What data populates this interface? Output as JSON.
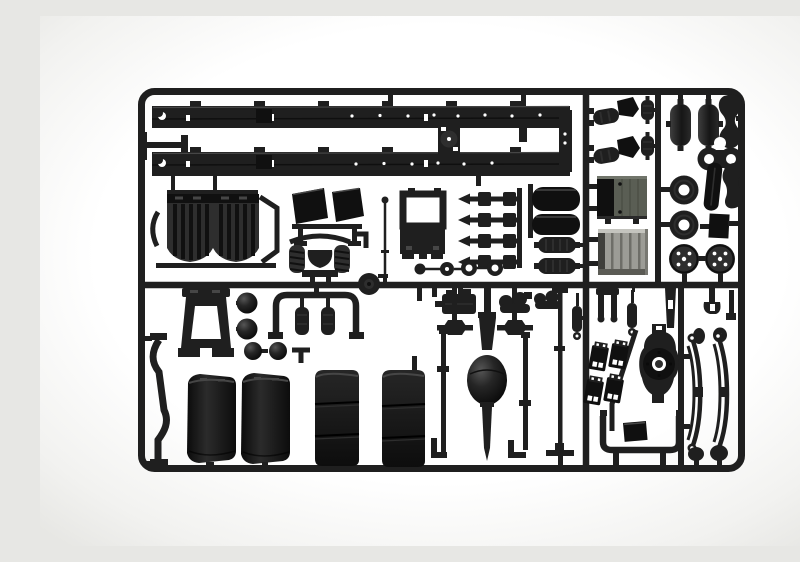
{
  "scene": {
    "subject": "Photograph of a black injection-molded plastic model kit sprue (parts tree) containing truck chassis parts",
    "background": "white studio background",
    "sprue_shape": "rounded rectangular frame with internal runners"
  },
  "colors": {
    "paper": "#ffffff",
    "edge": "#e7e7e4",
    "plastic": "#1f1f1f",
    "deep": "#101010",
    "mid": "#2e2e2e",
    "hl": "#464646",
    "boxface": "#5a5e54",
    "boxline": "#4b4f45",
    "ribgray": "#9c9c96",
    "ribline": "#6e6e68"
  },
  "parts": [
    {
      "name": "chassis-ladder-frame-rail",
      "count": 2
    },
    {
      "name": "ribbed-rear-fender",
      "count": 2
    },
    {
      "name": "quarter-fender-flap",
      "count": 2
    },
    {
      "name": "cab-suspension-with-coil-springs",
      "count": 1
    },
    {
      "name": "torque-rod",
      "count": 4
    },
    {
      "name": "saddle-tank",
      "count": 2
    },
    {
      "name": "ribbed-air-cylinder",
      "count": 2
    },
    {
      "name": "small-disc-wheel",
      "count": 4
    },
    {
      "name": "air-filter-assembly",
      "count": 2
    },
    {
      "name": "small-canister",
      "count": 2
    },
    {
      "name": "battery-box",
      "count": 1
    },
    {
      "name": "ribbed-fuel-tank",
      "count": 1
    },
    {
      "name": "air-tank-cylinder",
      "count": 2
    },
    {
      "name": "suspension-wishbone",
      "count": 2
    },
    {
      "name": "bone-link-with-holes",
      "count": 1
    },
    {
      "name": "leaf-spring-plate",
      "count": 1
    },
    {
      "name": "wheel-rim-donut",
      "count": 2
    },
    {
      "name": "mounting-plate",
      "count": 1
    },
    {
      "name": "brake-drum-hub",
      "count": 2
    },
    {
      "name": "curved-step-bracket",
      "count": 1
    },
    {
      "name": "cab-tilt-stand",
      "count": 1
    },
    {
      "name": "parts-stand-frame",
      "count": 1
    },
    {
      "name": "sphere-tank-end",
      "count": 4
    },
    {
      "name": "cab-rear-frame-with-filters",
      "count": 1
    },
    {
      "name": "smooth-fender",
      "count": 2
    },
    {
      "name": "box-fender",
      "count": 2
    },
    {
      "name": "rear-axle-with-differential",
      "count": 1
    },
    {
      "name": "drive-shaft",
      "count": 2
    },
    {
      "name": "stabilizer-shaft",
      "count": 1
    },
    {
      "name": "shock-absorber",
      "count": 2
    },
    {
      "name": "tow-clevis-fork",
      "count": 1
    },
    {
      "name": "mud-flap",
      "count": 4
    },
    {
      "name": "differential-cover",
      "count": 1
    },
    {
      "name": "step-tube-u-bracket",
      "count": 1
    },
    {
      "name": "leaf-spring",
      "count": 2
    },
    {
      "name": "gearbox-block",
      "count": 1
    },
    {
      "name": "axle-end-link",
      "count": 2
    },
    {
      "name": "u-joint-coupling",
      "count": 2
    },
    {
      "name": "antenna-rod",
      "count": 1
    },
    {
      "name": "pulley-disc",
      "count": 1
    }
  ]
}
